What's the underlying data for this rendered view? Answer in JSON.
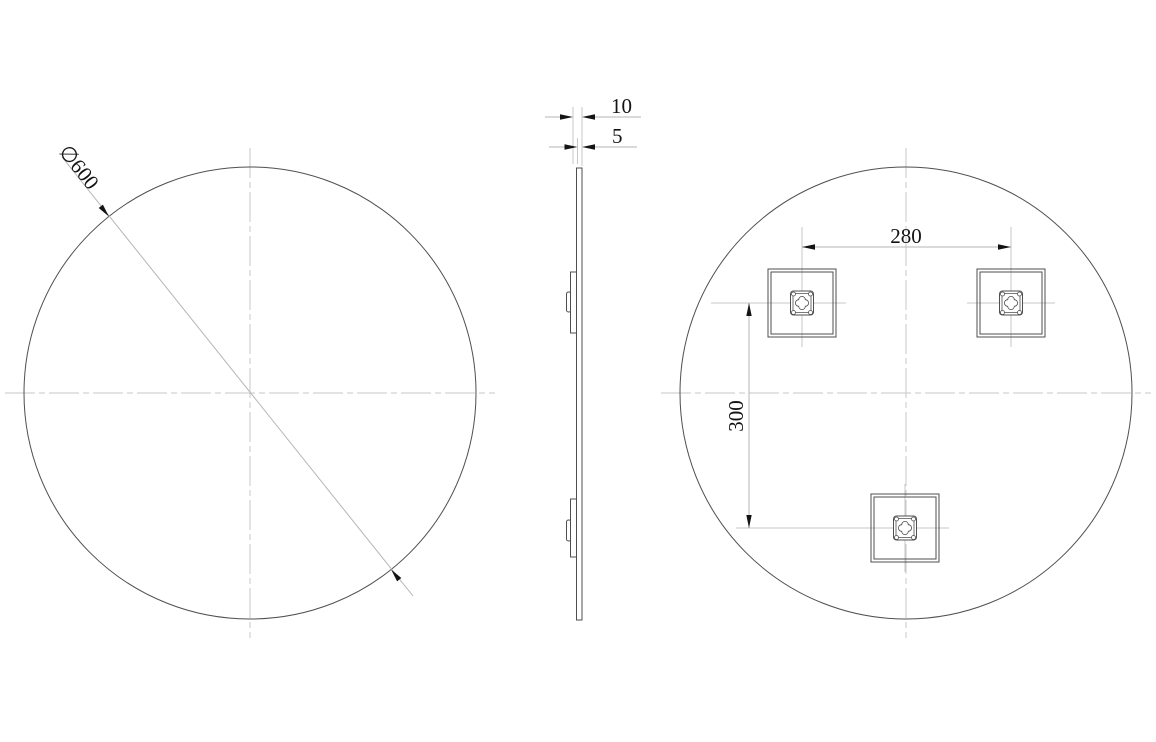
{
  "colors": {
    "line_dark": "#4f4f4f",
    "line_light": "#c7c7c7",
    "dim_line": "#b5b5b5",
    "text": "#141414",
    "background": "#ffffff"
  },
  "drawing": {
    "front_view": {
      "diameter_label": "∅600"
    },
    "side_view": {
      "overall_depth_label": "10",
      "glass_thickness_label": "5"
    },
    "back_view": {
      "bracket_spacing_horizontal_label": "280",
      "bracket_spacing_vertical_label": "300"
    }
  }
}
